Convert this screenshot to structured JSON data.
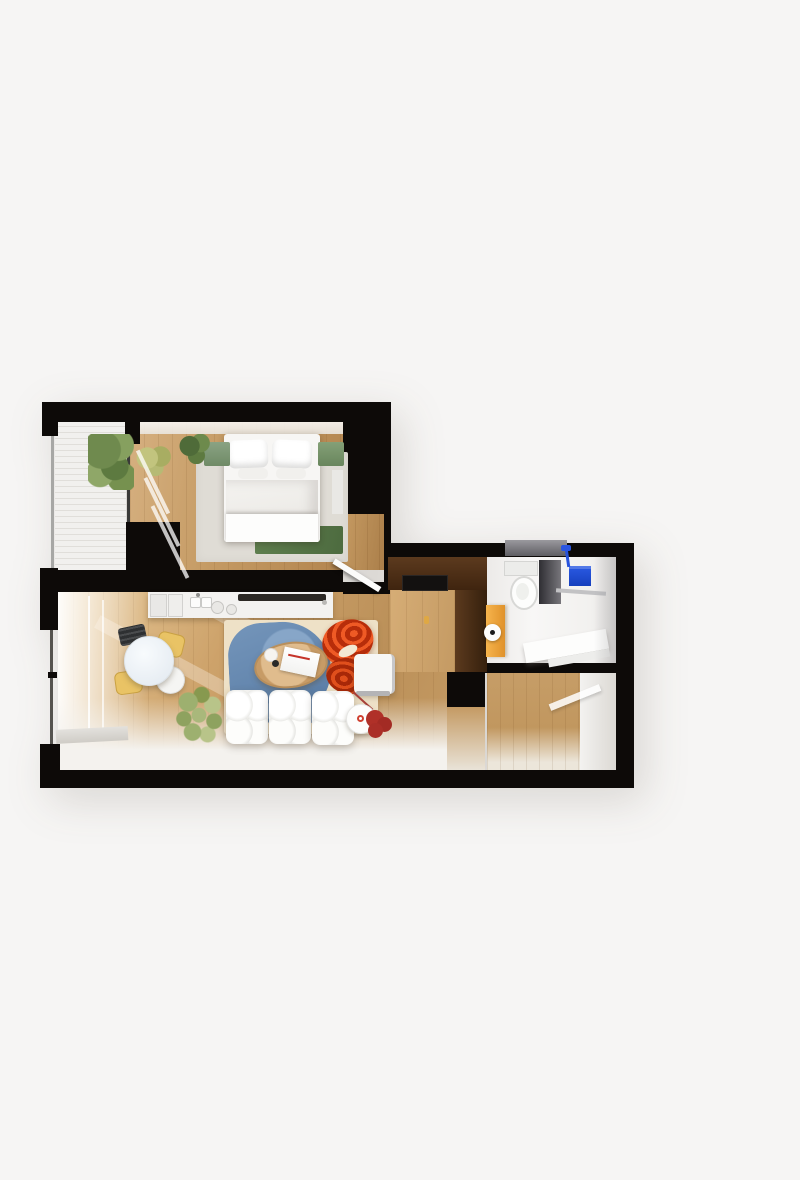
{
  "scene": {
    "kind": "3d-apartment-floor-plan-render",
    "no_visible_text": true,
    "palette": {
      "bg": "#f6f5f4",
      "wall": "#0d0a08",
      "wood": "#c9a266",
      "wood_light": "#e2c394",
      "wood_dark": "#b0854f",
      "wood_pale": "#efe3c8",
      "balcony": "#f2f1ef",
      "wardrobe_dark": "#4a2c15",
      "wardrobe_mid": "#6b4423",
      "entry_wood": "#cfa770",
      "counter": "#f3f2f0",
      "rug_base": "#eee1c7",
      "rug_blue": "#6f90b6",
      "rug_blue_dark": "#52749e",
      "armchair": "#d8400f",
      "armchair_dark": "#b02c0a",
      "red_table": "#b03028",
      "chair_yellow": "#e9c365",
      "cabinet_yellow": "#f0a73c",
      "shower_blue": "#1d4ed8",
      "bed_green": "#86a078",
      "runner_green": "#587747",
      "plant": "#7d9455",
      "plant_light": "#a9b87b",
      "gray_panel": "#3c3b40",
      "white": "#fbfbfa",
      "gloss": "#f4f2ee"
    },
    "rooms": [
      {
        "name": "bedroom",
        "furniture": [
          "double-bed",
          "pillows",
          "duvet",
          "area-rug-gray",
          "green-bench-left",
          "green-bench-right",
          "green-runner",
          "plant",
          "curtains",
          "door-leaf"
        ]
      },
      {
        "name": "balcony",
        "furniture": [
          "slatted-floor",
          "potted-plants",
          "glass-partition"
        ]
      },
      {
        "name": "living-room",
        "furniture": [
          "kitchen-counter",
          "sink",
          "cooktop",
          "dining-table",
          "black-chair",
          "yellow-chair",
          "yellow-chair",
          "white-chair",
          "blue-area-rug",
          "oval-coffee-table",
          "book",
          "white-modular-sofa",
          "red-armchair",
          "white-pouf",
          "floor-lamp",
          "red-side-table",
          "plant"
        ]
      },
      {
        "name": "entry",
        "furniture": [
          "dark-wardrobe",
          "black-appliance-front",
          "wood-panel",
          "brass-handle"
        ]
      },
      {
        "name": "bathroom",
        "furniture": [
          "toilet",
          "shower-partition",
          "blue-shower-towel",
          "shower-head",
          "yellow-cabinet",
          "toilet-paper-roll",
          "vanity-counter",
          "gray-shelf"
        ]
      },
      {
        "name": "hallway",
        "furniture": [
          "wood-floor",
          "door-streak"
        ]
      }
    ]
  }
}
